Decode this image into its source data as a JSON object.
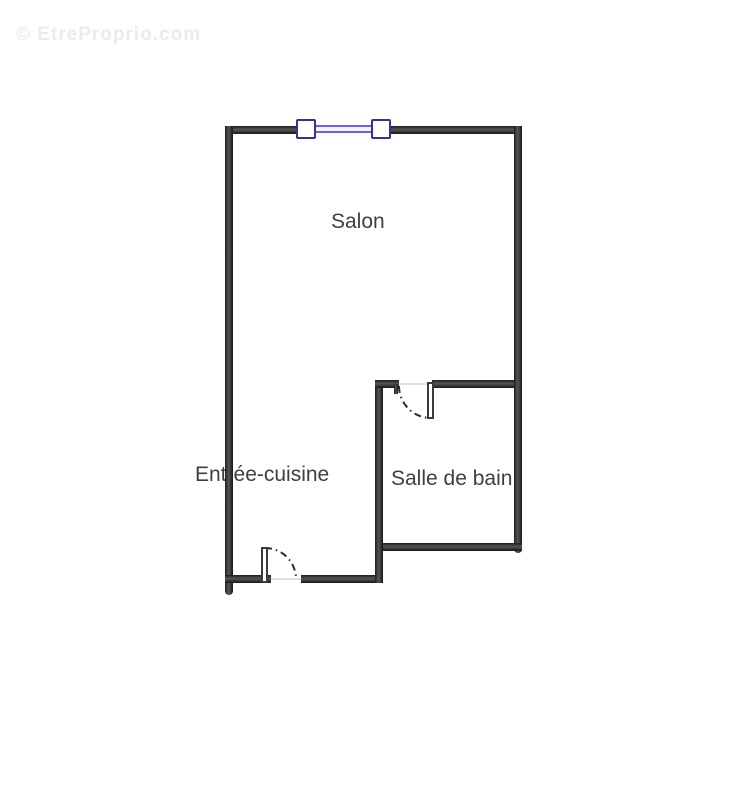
{
  "watermark": {
    "text": "© EtreProprio.com"
  },
  "floor_plan": {
    "rooms": [
      {
        "name": "salon",
        "label": "Salon"
      },
      {
        "name": "entree-cuisine",
        "label": "Entrée-cuisine"
      },
      {
        "name": "salle-de-bain",
        "label": "Salle de bain"
      }
    ],
    "features": [
      {
        "name": "window-symbol",
        "location": "top wall of salon"
      },
      {
        "name": "door-swing-bathroom",
        "location": "opening between salon and salle de bain"
      },
      {
        "name": "door-swing-entrance",
        "location": "bottom wall of entrée-cuisine"
      }
    ],
    "colors": {
      "wall": "#3f3f3f",
      "wall_edge": "#1c1c1c",
      "window_frame": "#34348c",
      "window_glass": "#6a68c8",
      "label_text": "#3f3f3f",
      "watermark": "#ebebeb",
      "background": "#ffffff"
    }
  }
}
